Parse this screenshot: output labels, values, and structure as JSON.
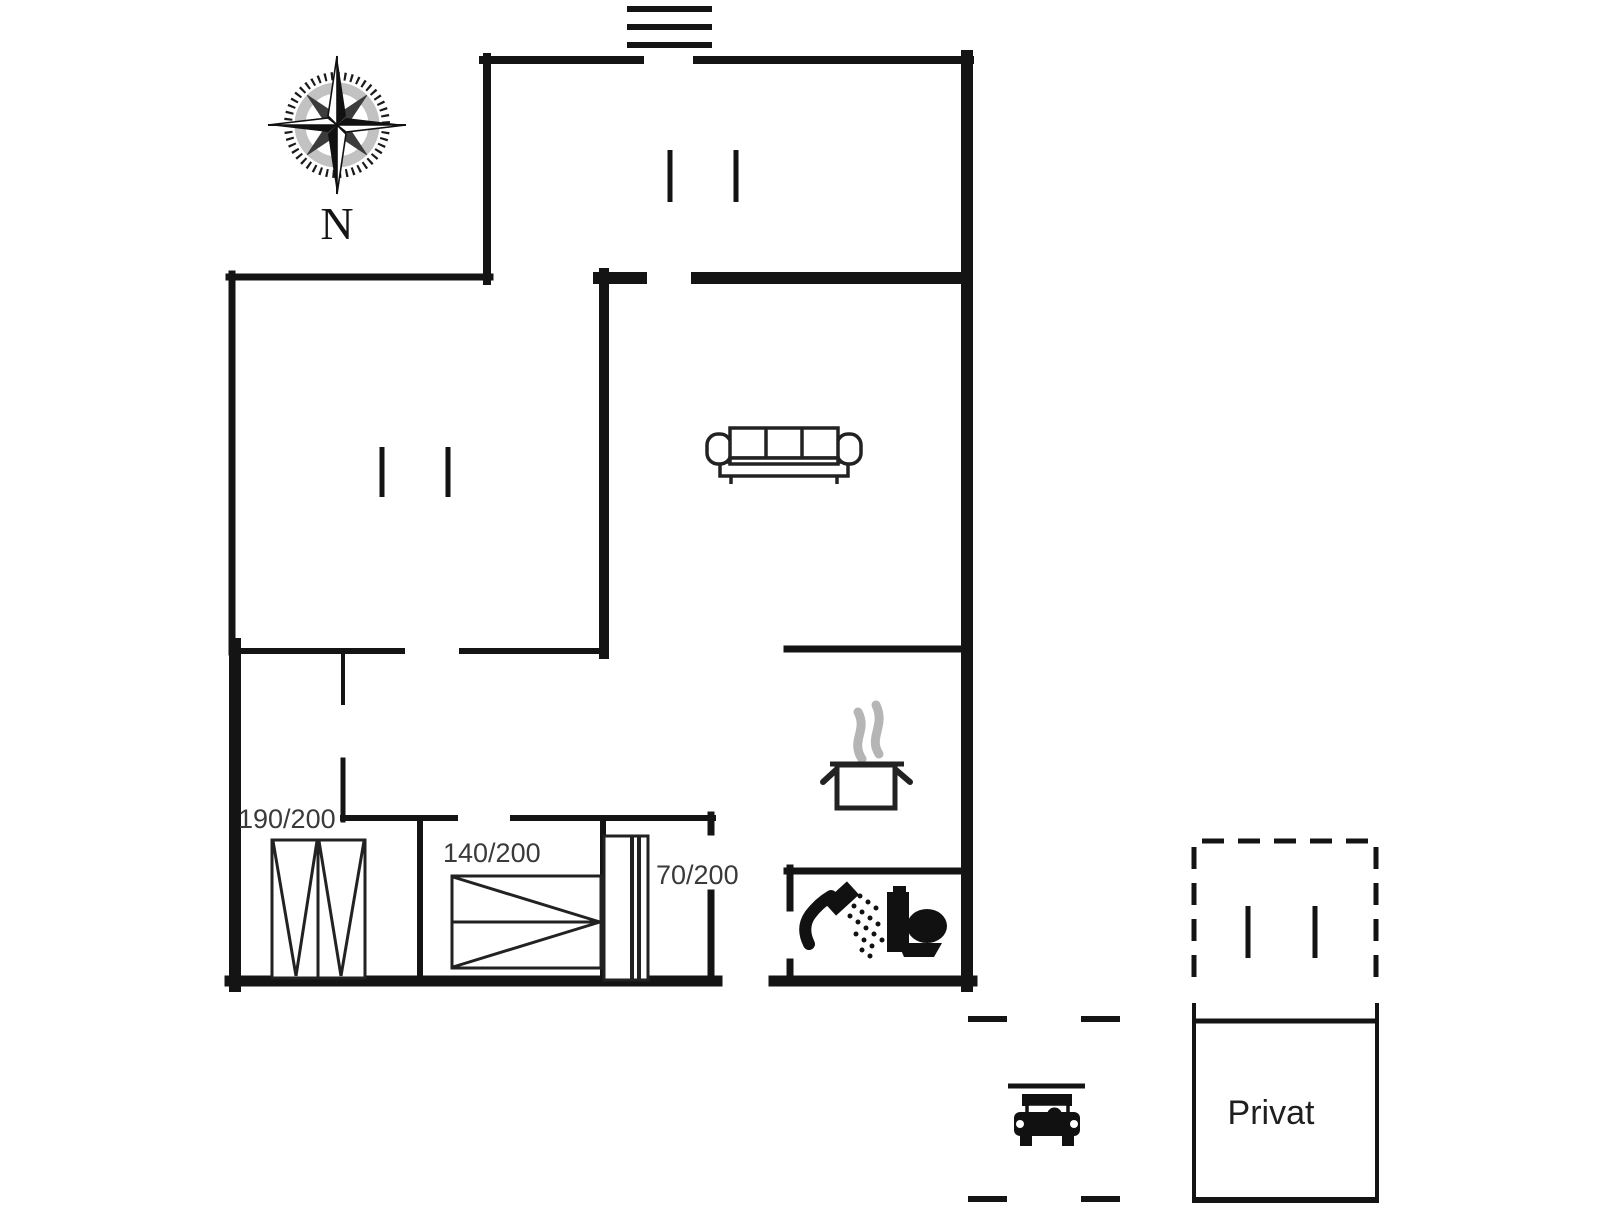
{
  "plan": {
    "compass": {
      "north_label": "N"
    },
    "bed_labels": {
      "double": "190/200",
      "mid": "140/200",
      "single": "70/200"
    },
    "room_labels": {
      "private": "Privat"
    },
    "icon_names": {
      "compass": "compass-rose-icon",
      "entrance_steps": "entrance-steps-icon",
      "window_marker": "window-marker-icon",
      "sofa": "sofa-icon",
      "cooking_pot": "cooking-pot-icon",
      "shower": "shower-icon",
      "toilet": "toilet-icon",
      "car": "car-icon"
    },
    "colors": {
      "wall": "#141414",
      "furniture": "#222222",
      "label_text": "#3a3a3a",
      "steam": "#b5b5b5",
      "background": "#ffffff"
    }
  }
}
